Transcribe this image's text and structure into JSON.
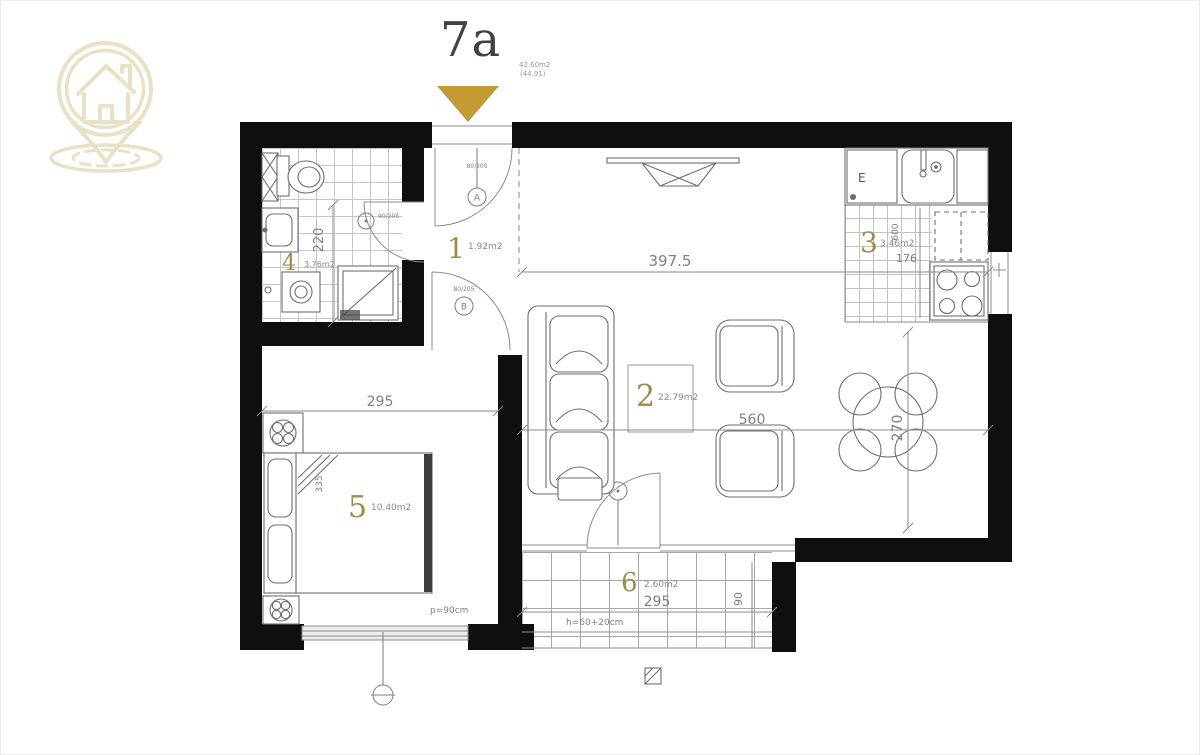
{
  "header": {
    "unit": "7a",
    "net_area": "42.60m2",
    "gross_area": "(44.91)"
  },
  "icons": {
    "logo": "house-location-pin-logo",
    "entry_marker": "gold-entry-triangle"
  },
  "rooms": [
    {
      "num": "1",
      "area": "1.92m2"
    },
    {
      "num": "2",
      "area": "22.79m2"
    },
    {
      "num": "3",
      "area": "3.46m2"
    },
    {
      "num": "4",
      "area": "3.76m2"
    },
    {
      "num": "5",
      "area": "10.40m2"
    },
    {
      "num": "6",
      "area": "2.60m2"
    }
  ],
  "dims": {
    "living_width": "397.5",
    "bedroom_width": "295",
    "dining_width": "560",
    "dining_depth": "270",
    "bath_depth": "220",
    "counter_depth": "600",
    "kitchen_depth": "176",
    "bed_width": "335",
    "terrace_width": "295",
    "terrace_depth": "90",
    "window_parapet": "p=90cm",
    "balcony_parapet": "h=60+20cm"
  },
  "markers": {
    "entrance_letter": "A",
    "entrance_size": "80/205",
    "hall_letter": "B",
    "hall_size": "80/205",
    "bath_size": "90/205",
    "kitchen_e": "E"
  }
}
